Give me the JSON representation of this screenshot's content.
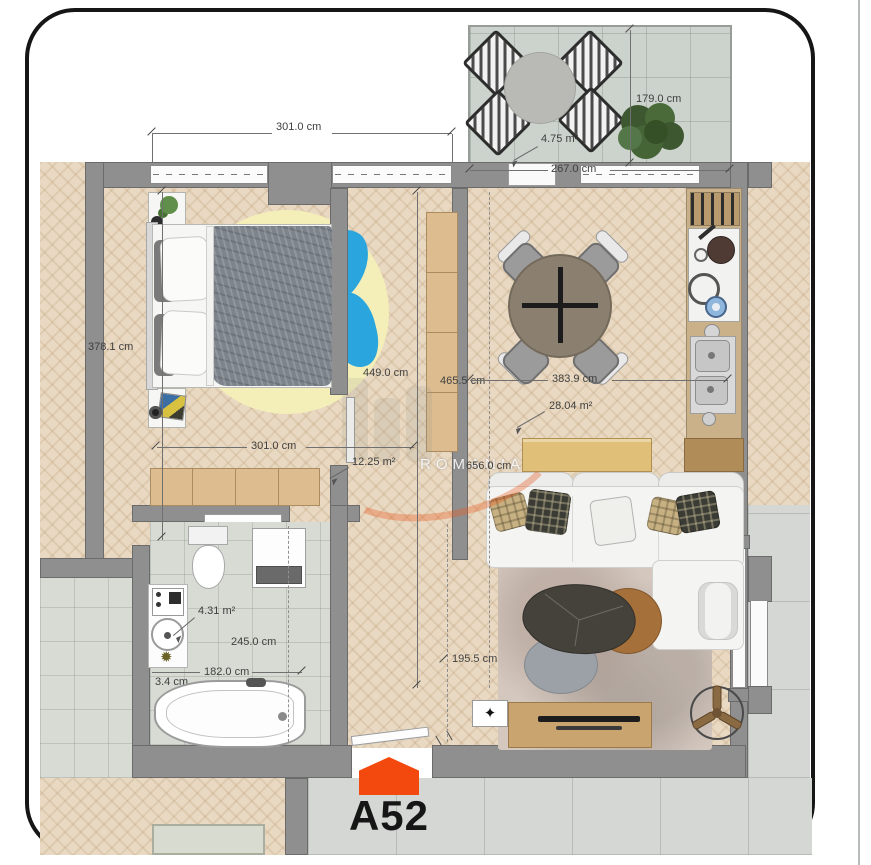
{
  "unit": {
    "label": "A52"
  },
  "watermark": {
    "text": "ROMANIA"
  },
  "colors": {
    "marker_orange": "#F3490E",
    "highlight_yellow": "#F4EEB9",
    "logo_blue": "#2AA5DE",
    "wall_gray": "#8F8F8F"
  },
  "dimensions": {
    "bedroom_top_width": "301.0 cm",
    "terrace_depth": "179.0 cm",
    "terrace_area": "4.75 m²",
    "terrace_width": "267.0 cm",
    "bedroom_left_height": "378.1 cm",
    "hall_length": "449.0 cm",
    "living_left_length": "465.5 cm",
    "living_width": "383.9 cm",
    "living_area": "28.04 m²",
    "bedroom_bottom_width": "301.0 cm",
    "bedroom_area": "12.25 m²",
    "living_total_length": "656.0 cm",
    "entry_length": "195.5 cm",
    "bathroom_area": "4.31 m²",
    "bathroom_length": "245.0 cm",
    "bathroom_width": "182.0 cm",
    "bathroom_small": "3.4 cm"
  }
}
